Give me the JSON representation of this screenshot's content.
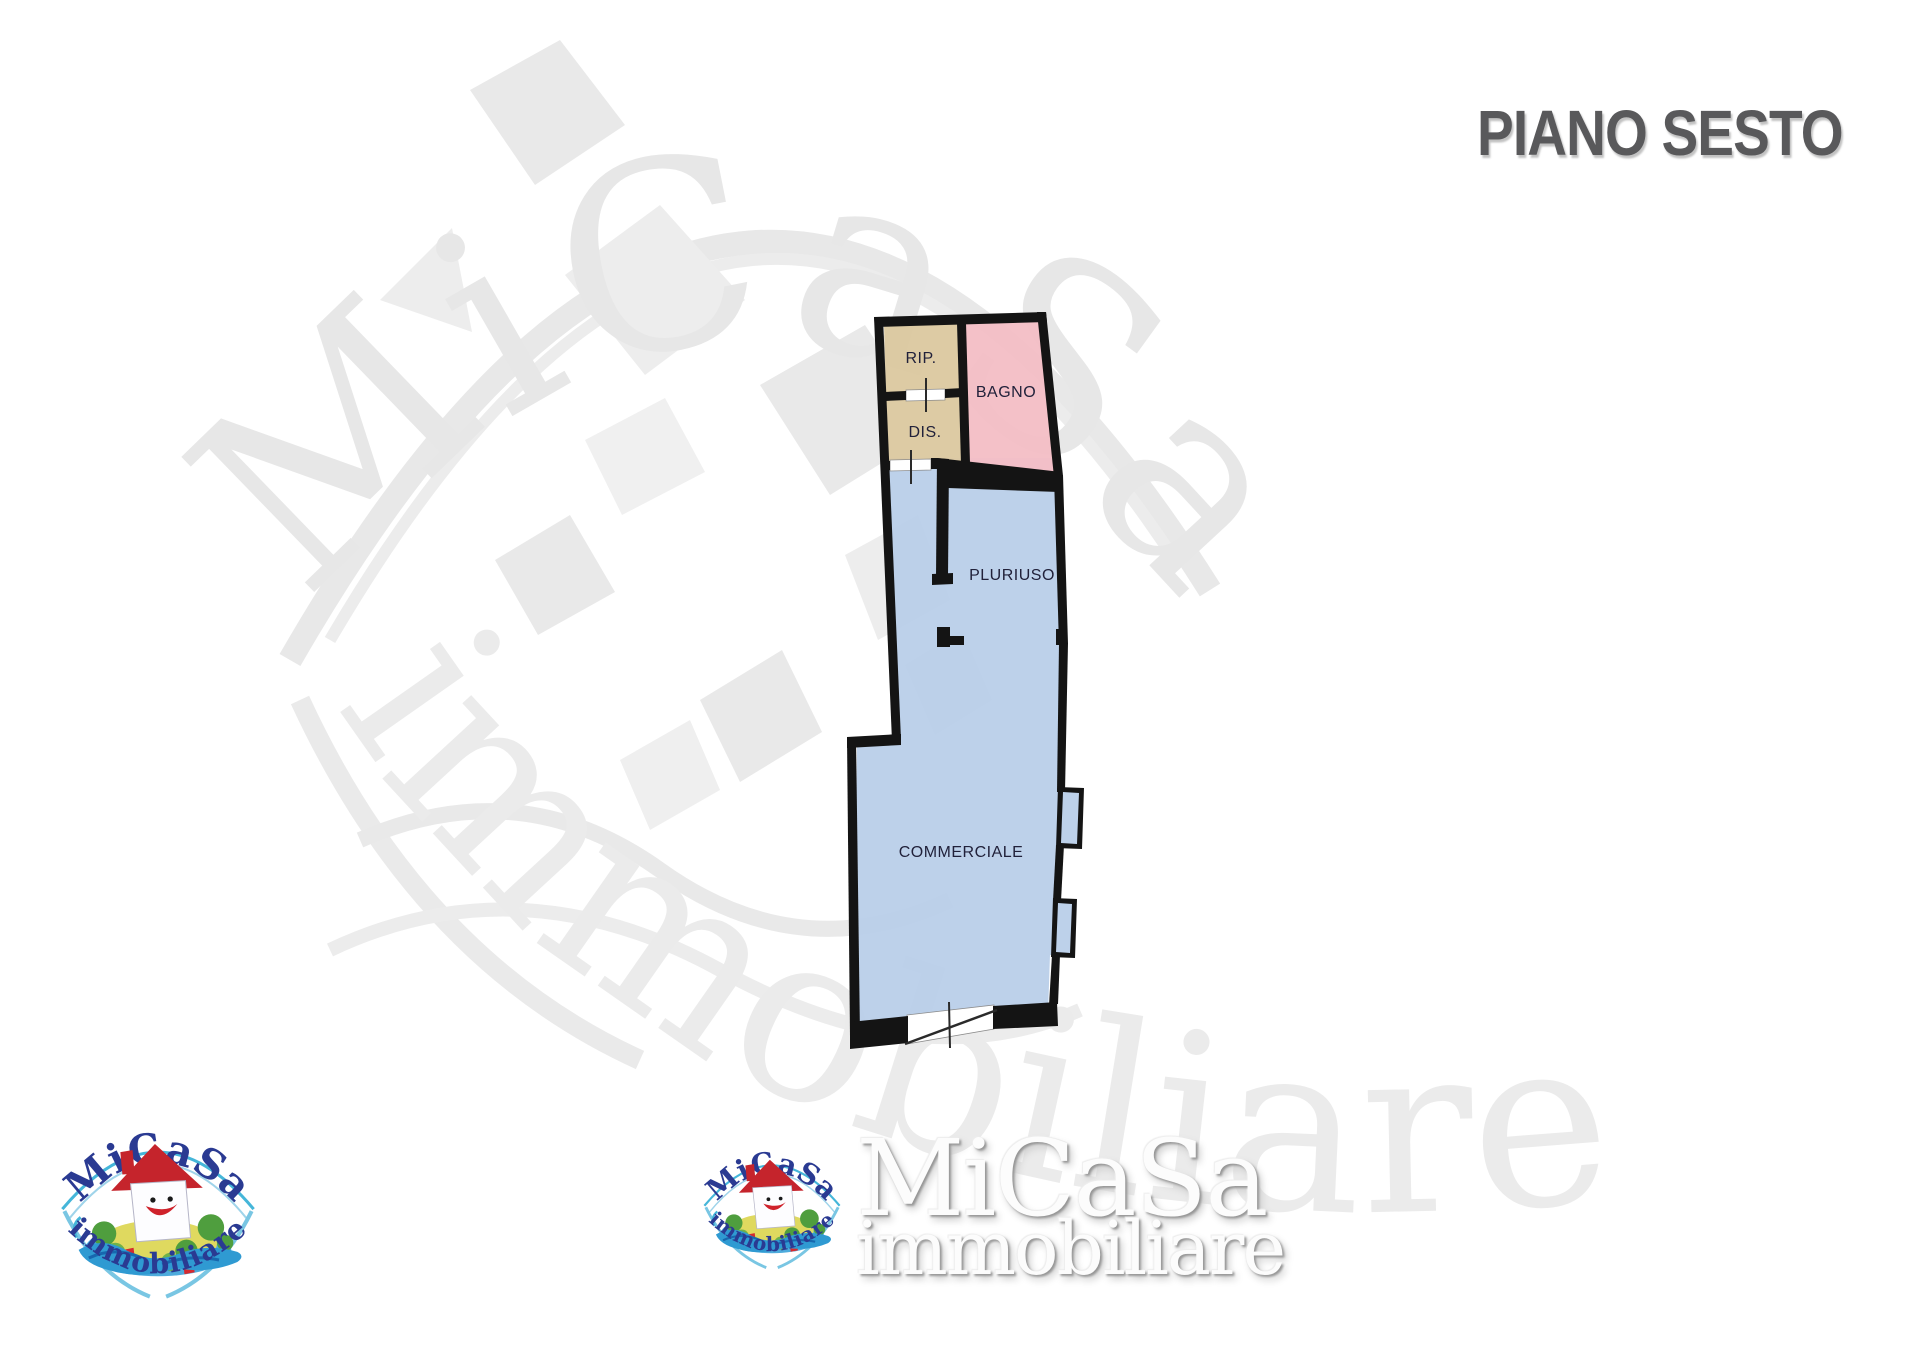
{
  "page": {
    "title": "PIANO SESTO"
  },
  "floor_plan": {
    "rooms": {
      "rip": "RIP.",
      "dis": "DIS.",
      "bagno": "BAGNO",
      "pluriuso": "PLURIUSO",
      "commerciale": "COMMERCIALE"
    },
    "colors": {
      "storage_fill": "#dcc9a0",
      "bath_fill": "#f4bec6",
      "main_fill": "#b8cee8",
      "wall": "#141414"
    }
  },
  "branding": {
    "logo_title": "MiCaSa",
    "logo_subtitle": "immobiliare"
  },
  "footer_wordmark": {
    "title": "MiCaSa",
    "subtitle": "immobiliare"
  },
  "watermark": {
    "title": "MiCaSa",
    "subtitle": "immobiliare"
  }
}
